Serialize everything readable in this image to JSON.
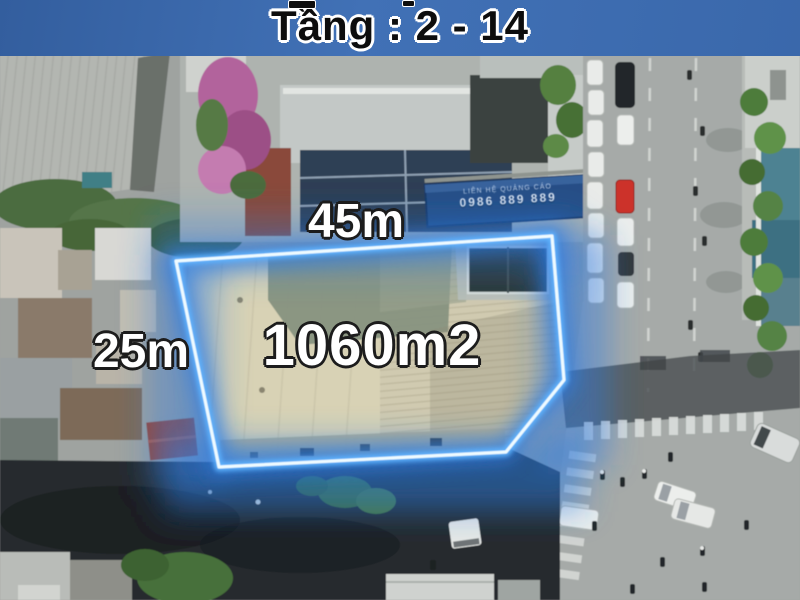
{
  "banner": {
    "title": "Tầng : 2 - 14"
  },
  "property": {
    "top_dimension": "45m",
    "left_dimension": "25m",
    "area": "1060m2"
  },
  "billboard": {
    "line1": "LIÊN HỆ QUẢNG CÁO",
    "line2": "0986 889 889"
  },
  "colors": {
    "banner_bg": "#4171b6",
    "banner_bg_edge": "#335e9e",
    "banner_text": "#0d0d0d",
    "banner_text_outline": "#ffffff",
    "label_text": "#ffffff",
    "label_outline": "#1c1c1c",
    "outline_core": "#effbff",
    "outline_glow": "#2d7de4",
    "roof_beige": "#d8d2b5",
    "roof_shadow_green": "#87927f",
    "road_gray": "#a6aaa8",
    "street_shadow": "#262b2f",
    "tree_green": "#4e7a3c",
    "car_red": "#cc332a"
  }
}
